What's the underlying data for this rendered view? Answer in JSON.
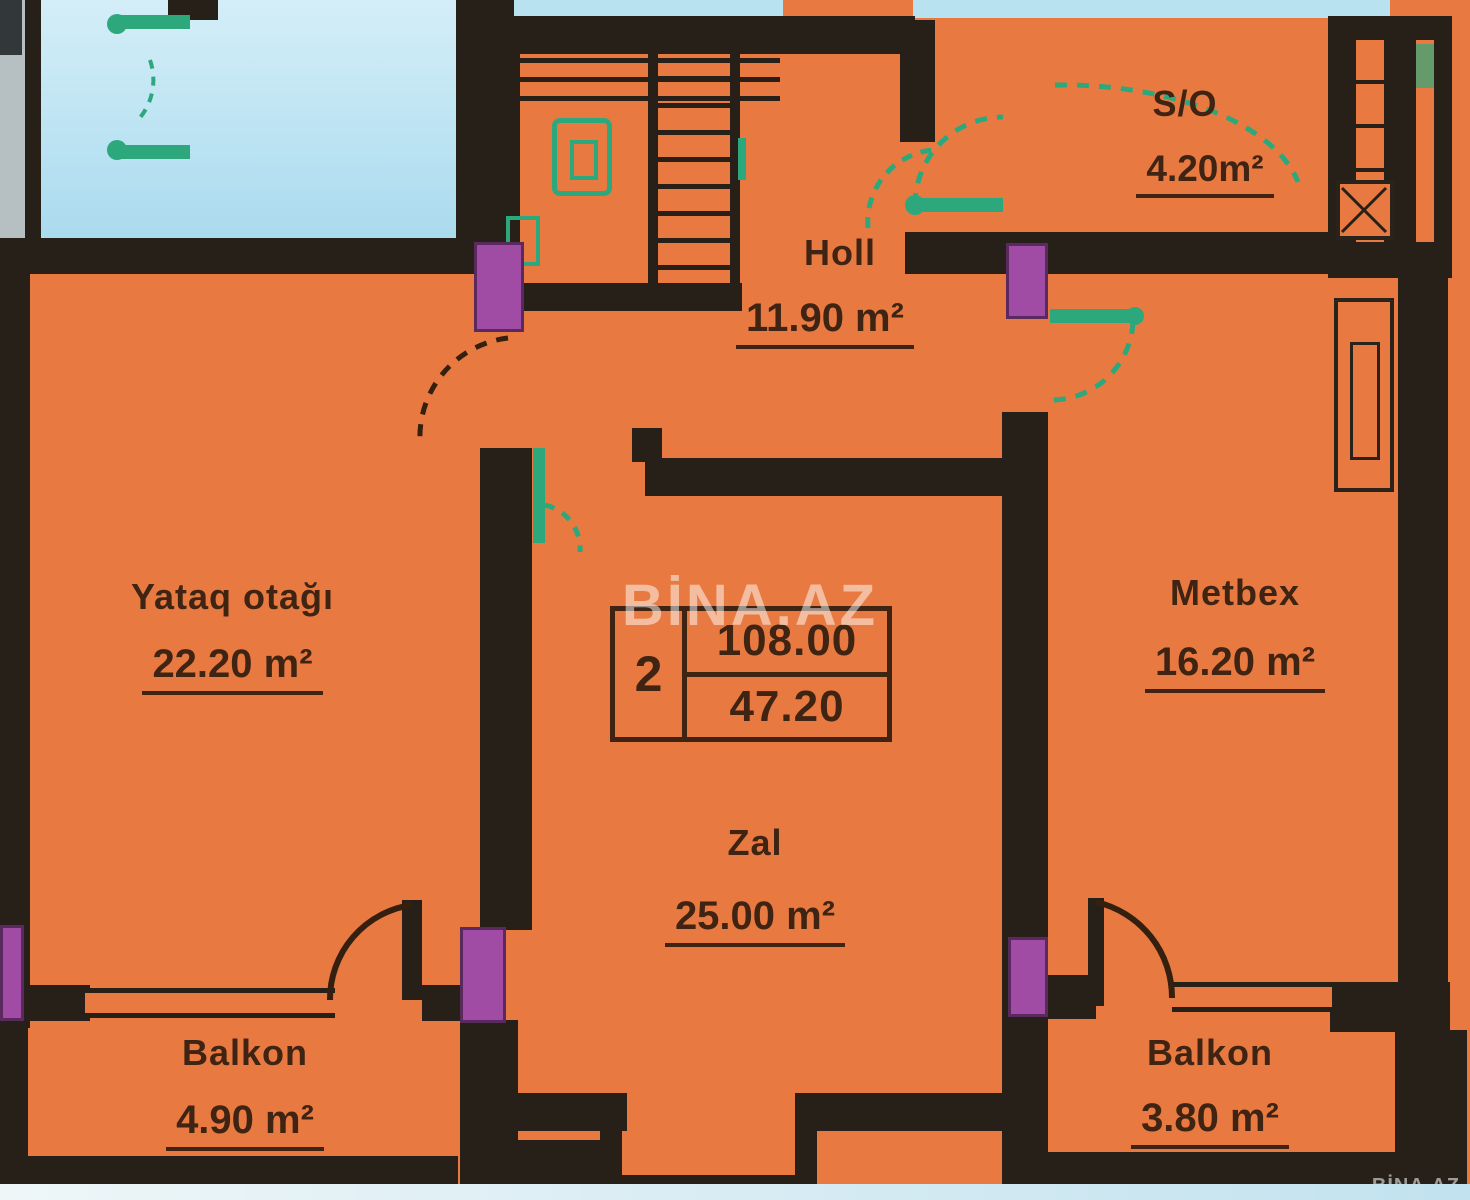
{
  "title": "Apartment floor plan",
  "watermark": {
    "large": "BİNA.AZ",
    "small": "BİNA.AZ"
  },
  "info_box": {
    "room_count": "2",
    "total_area": "108.00",
    "living_area": "47.20"
  },
  "rooms": {
    "bedroom": {
      "name": "Yataq otağı",
      "area": "22.20 m²"
    },
    "hall": {
      "name": "Holl",
      "area": "11.90 m²"
    },
    "sanitary": {
      "name": "S/O",
      "area": "4.20m²"
    },
    "kitchen": {
      "name": "Metbex",
      "area": "16.20 m²"
    },
    "living": {
      "name": "Zal",
      "area": "25.00 m²"
    },
    "balcony_left": {
      "name": "Balkon",
      "area": "4.90 m²"
    },
    "balcony_right": {
      "name": "Balkon",
      "area": "3.80 m²"
    }
  },
  "colors": {
    "floor_orange": "#e87a41",
    "wall_black": "#262019",
    "block_purple": "#a04ca4",
    "fixture_teal": "#2da87d",
    "neighbor_blue": "#b9e2f1",
    "text_brown": "#3f2413"
  }
}
